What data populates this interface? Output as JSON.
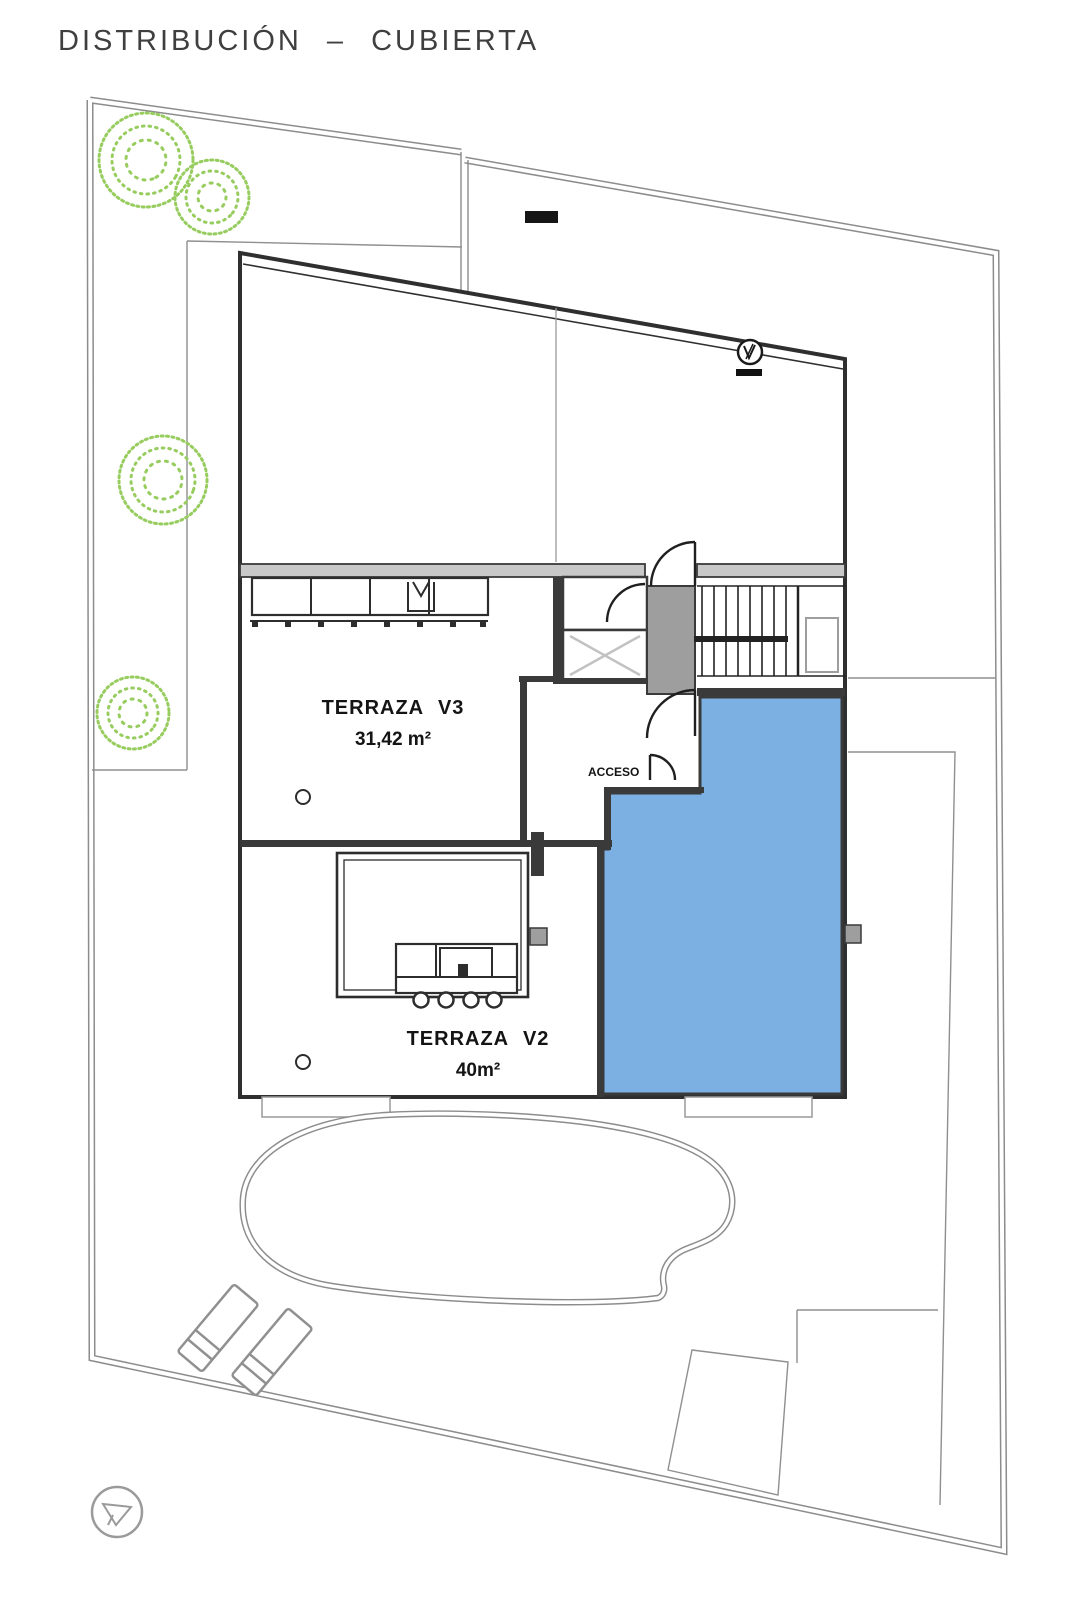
{
  "title": "DISTRIBUCIÓN – CUBIERTA",
  "plan": {
    "rooms": [
      {
        "id": "terraza-v3",
        "label": "TERRAZA V3",
        "area": "31,42 m²"
      },
      {
        "id": "terraza-v2",
        "label": "TERRAZA V2",
        "area": "40m²"
      }
    ],
    "annotations": [
      {
        "id": "acceso",
        "label": "ACCESO"
      }
    ],
    "features": [
      "pool",
      "stairs",
      "elevator",
      "pergola-bar",
      "outdoor-kitchen",
      "lounge-chairs",
      "trees",
      "north-indicator",
      "level-marker",
      "solarium"
    ],
    "colors": {
      "solarium_blue": "#7db0e2",
      "tree_green": "#97cc5e",
      "wall_dark": "#3a3a3a",
      "line_gray": "#8f8f8f",
      "lobby_gray": "#9e9e9e"
    }
  }
}
